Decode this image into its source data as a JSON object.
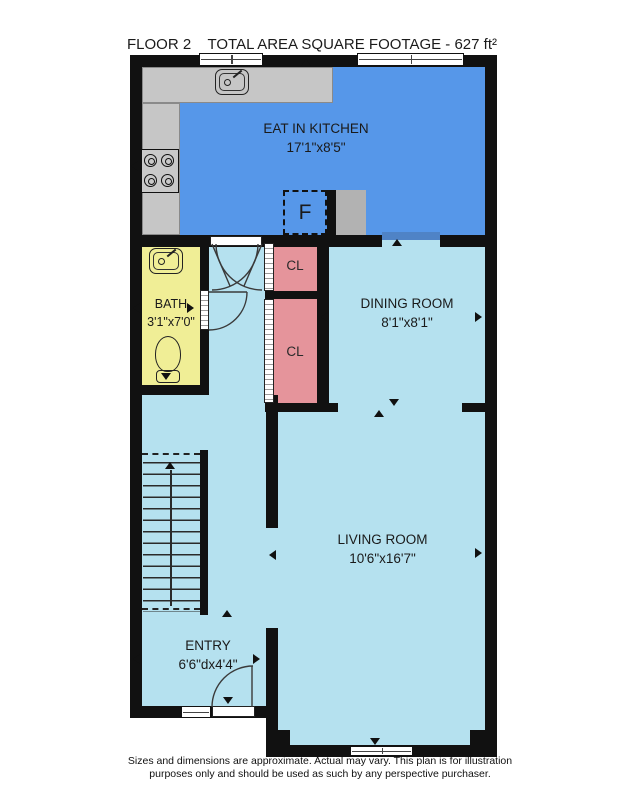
{
  "header": {
    "floor_label": "FLOOR 2",
    "area_label": "TOTAL AREA SQUARE FOOTAGE - 627 ft²"
  },
  "rooms": {
    "kitchen": {
      "name": "EAT IN KITCHEN",
      "dims": "17'1\"x8'5\""
    },
    "dining": {
      "name": "DINING ROOM",
      "dims": "8'1\"x8'1\""
    },
    "living": {
      "name": "LIVING ROOM",
      "dims": "10'6\"x16'7\""
    },
    "bath": {
      "name": "BATH",
      "dims": "3'1\"x7'0\""
    },
    "entry": {
      "name": "ENTRY",
      "dims": "6'6\"dx4'4\""
    },
    "closet_upper": {
      "name": "CL"
    },
    "closet_lower": {
      "name": "CL"
    },
    "fridge_label": "F"
  },
  "footer": {
    "line1": "Sizes and dimensions are approximate. Actual may vary. This plan is for illustration",
    "line2": "purposes only and should be used as such by any perspective purchaser."
  },
  "colors": {
    "wall": "#111111",
    "kitchen_floor": "#5697e9",
    "kitchen_floor_edge": "#4f83c6",
    "room_floor": "#b5e1ef",
    "bath_floor": "#f0ee96",
    "closet_floor": "#e5949b",
    "counter": "#c6c6c6",
    "appliance_gray": "#b2b2b2"
  }
}
